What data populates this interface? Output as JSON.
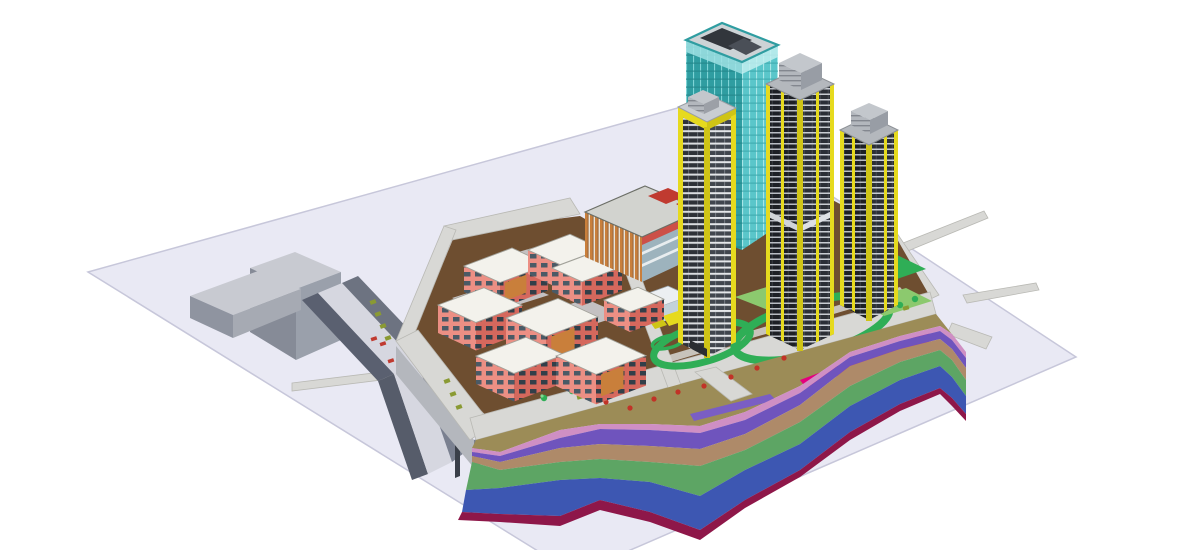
{
  "view": {
    "type": "axonometric-3d-bim-model",
    "background": "#ffffff"
  },
  "palette": {
    "plane": "#e9e9f4",
    "planeEdge": "#c7c7da",
    "road": "#d8d8d5",
    "roadEdge": "#b9b9b4",
    "earth": "#6e4e30",
    "lawn": "#2fae56",
    "lawnLight": "#8cc96e",
    "pad": "#cdced3",
    "bankTan": "#9c8c57",
    "grayBoxTop": "#c8cad1",
    "grayBoxSide": "#8f94a0",
    "grayBoxDark": "#5a6070",
    "rampDeck": "#d6d7e0",
    "curb": "#b4b7bd",
    "roofLight": "#f3f2ec",
    "salmon": "#ec8f84",
    "salmonDark": "#d5685d",
    "louver": "#c97f3b",
    "podiumRoof": "#d2d3cf",
    "teal": "#4fc0c4",
    "tealDark": "#2f9da1",
    "towerDark": "#1d2025",
    "towerDark2": "#2b2f36",
    "slab": "#c9cdd3",
    "safetyYellow": "#e6da1e",
    "safetyYellowDark": "#cfc416",
    "penthouse": "#c3c7cc",
    "accentRed": "#c03a30",
    "hotPink": "#e4007e",
    "shrubRed": "#c13327",
    "glyphOlive": "#8a9a33"
  },
  "strata_layers": [
    {
      "name": "surface-fill",
      "color": "#9c8c57"
    },
    {
      "name": "layer-pink",
      "color": "#cf8fc4"
    },
    {
      "name": "layer-violet",
      "color": "#6f54bd"
    },
    {
      "name": "layer-tan",
      "color": "#ae8a69"
    },
    {
      "name": "layer-green",
      "color": "#5da564"
    },
    {
      "name": "layer-blue",
      "color": "#3d57b2"
    },
    {
      "name": "layer-maroon",
      "color": "#8e1749"
    }
  ],
  "model": {
    "towers": [
      {
        "name": "curtain-wall-tower"
      },
      {
        "name": "residential-tower-west"
      },
      {
        "name": "residential-tower-middle"
      },
      {
        "name": "residential-tower-east"
      }
    ],
    "podium": {
      "name": "retail-podium"
    },
    "lowrise_count": 8,
    "roads": [
      "north-road",
      "west-road",
      "southwest-road",
      "frontage-road",
      "internal-road",
      "east-road",
      "offsite-stubs"
    ]
  },
  "lowrise_blocks": [
    {
      "x": 464,
      "y": 266,
      "a": 48,
      "b": 36,
      "h": 26,
      "louver": true
    },
    {
      "x": 528,
      "y": 250,
      "a": 42,
      "b": 32,
      "h": 24,
      "louver": false
    },
    {
      "x": 552,
      "y": 268,
      "a": 40,
      "b": 30,
      "h": 24,
      "louver": false
    },
    {
      "x": 438,
      "y": 305,
      "a": 46,
      "b": 38,
      "h": 28,
      "louver": false
    },
    {
      "x": 506,
      "y": 318,
      "a": 52,
      "b": 40,
      "h": 30,
      "louver": true
    },
    {
      "x": 476,
      "y": 356,
      "a": 50,
      "b": 38,
      "h": 28,
      "louver": false
    },
    {
      "x": 556,
      "y": 356,
      "a": 50,
      "b": 40,
      "h": 30,
      "louver": true
    },
    {
      "x": 604,
      "y": 300,
      "a": 34,
      "b": 26,
      "h": 20,
      "louver": false
    }
  ]
}
